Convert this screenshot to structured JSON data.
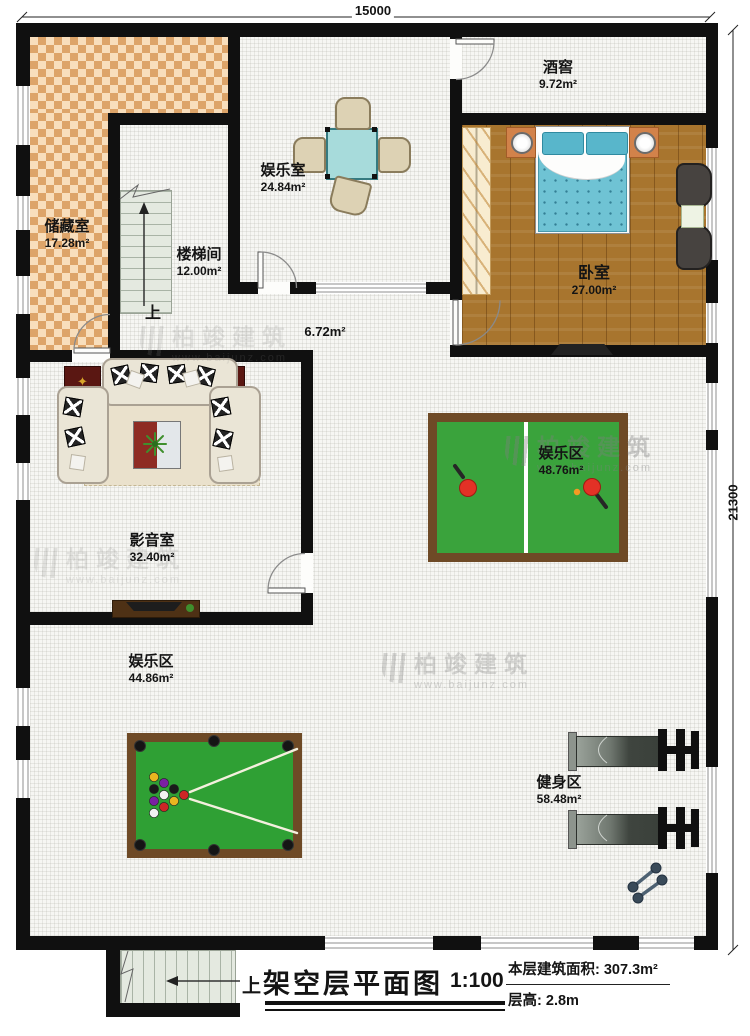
{
  "plan": {
    "dimensions": {
      "width_mm": "15000",
      "height_mm": "21300"
    },
    "rooms": [
      {
        "name": "储藏室",
        "area": "17.28m²"
      },
      {
        "name": "楼梯间",
        "area": "12.00m²"
      },
      {
        "name": "娱乐室",
        "area": "24.84m²"
      },
      {
        "name": "酒窖",
        "area": "9.72m²"
      },
      {
        "name": "卧室",
        "area": "27.00m²"
      },
      {
        "name": "影音室",
        "area": "32.40m²"
      },
      {
        "name": "娱乐区",
        "area": "48.76m²"
      },
      {
        "name": "娱乐区",
        "area": "44.86m²"
      },
      {
        "name": "健身区",
        "area": "58.48m²"
      }
    ],
    "corridor_area": "6.72m²",
    "stair_up_label": "上",
    "title_block": {
      "title": "架空层平面图",
      "scale": "1:100",
      "floor_area_label": "本层建筑面积:",
      "floor_area_value": "307.3m²",
      "floor_height_label": "层高:",
      "floor_height_value": "2.8m"
    },
    "watermark": {
      "brand": "柏竣建筑",
      "url": "www.baijunz.com"
    },
    "colors": {
      "wall": "#101010",
      "felt_green": "#38a23c",
      "wood_floor": "#a8752e",
      "checker_floor": "#dda469",
      "accent_teal": "#9fd8d8",
      "frame_brown": "#6e4a26",
      "bed_teal": "#6fc3d4"
    }
  }
}
